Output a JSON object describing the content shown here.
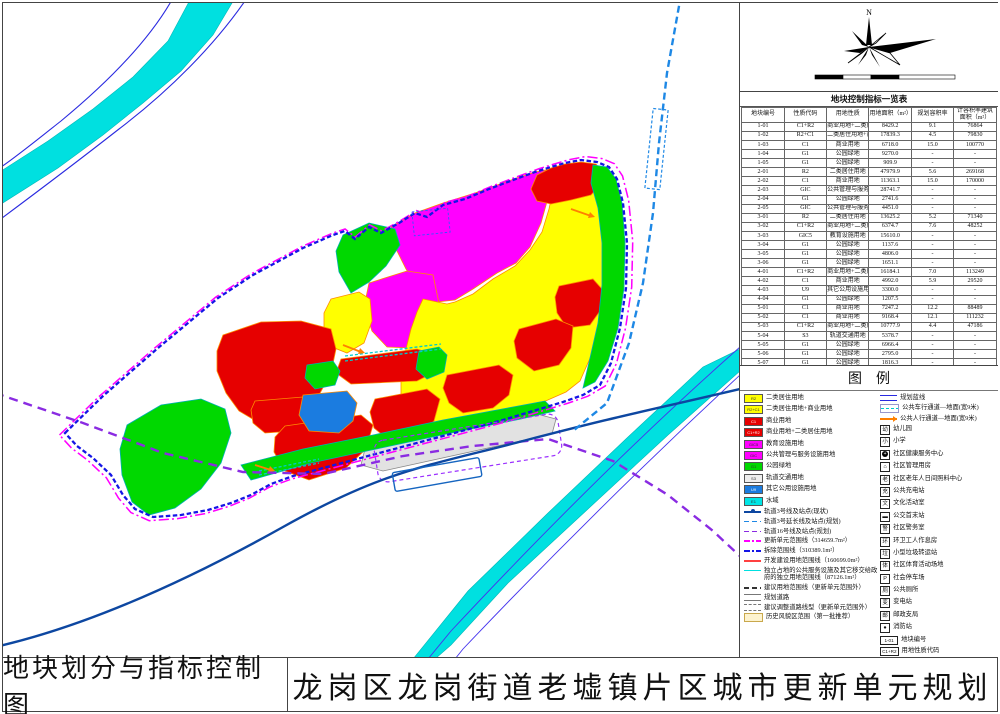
{
  "sheet": {
    "bottom_left": "地块划分与指标控制图",
    "bottom_right": "龙岗区龙岗街道老墟镇片区城市更新单元规划"
  },
  "compass": {
    "north_label": "N"
  },
  "scalebar": {
    "ticks": [
      "0",
      "40",
      "80",
      "120",
      "200m"
    ]
  },
  "table": {
    "title": "地块控制指标一览表",
    "headers": [
      "地块编号",
      "性质代码",
      "用地性质",
      "用地面积（m²）",
      "规划容积率",
      "计容积率建筑面积（m²）"
    ],
    "rows": [
      [
        "1-01",
        "C1+R2",
        "商业用地+二类居住用地",
        "8429.2",
        "9.1",
        "76864"
      ],
      [
        "1-02",
        "R2+C1",
        "二类居住用地+商业用地",
        "17839.3",
        "4.5",
        "79830"
      ],
      [
        "1-03",
        "C1",
        "商业用地",
        "6718.0",
        "15.0",
        "100770"
      ],
      [
        "1-04",
        "G1",
        "公园绿地",
        "9270.0",
        "-",
        "-"
      ],
      [
        "1-05",
        "G1",
        "公园绿地",
        "909.9",
        "-",
        "-"
      ],
      [
        "2-01",
        "R2",
        "二类居住用地",
        "47979.9",
        "5.6",
        "269168"
      ],
      [
        "2-02",
        "C1",
        "商业用地",
        "11363.1",
        "15.0",
        "170000"
      ],
      [
        "2-03",
        "GIC",
        "公共管理与服务设施用地",
        "28741.7",
        "-",
        "-"
      ],
      [
        "2-04",
        "G1",
        "公园绿地",
        "2741.6",
        "-",
        "-"
      ],
      [
        "2-05",
        "GIC",
        "公共管理与服务设施用地",
        "4451.0",
        "-",
        "-"
      ],
      [
        "3-01",
        "R2",
        "二类居住用地",
        "13625.2",
        "5.2",
        "71340"
      ],
      [
        "3-02",
        "C1+R2",
        "商业用地+二类居住用地",
        "6374.7",
        "7.6",
        "48252"
      ],
      [
        "3-03",
        "GIC5",
        "教育设施用地",
        "15610.0",
        "-",
        "-"
      ],
      [
        "3-04",
        "G1",
        "公园绿地",
        "1137.6",
        "-",
        "-"
      ],
      [
        "3-05",
        "G1",
        "公园绿地",
        "4806.0",
        "-",
        "-"
      ],
      [
        "3-06",
        "G1",
        "公园绿地",
        "1651.1",
        "-",
        "-"
      ],
      [
        "4-01",
        "C1+R2",
        "商业用地+二类居住用地",
        "16184.1",
        "7.0",
        "113249"
      ],
      [
        "4-02",
        "C1",
        "商业用地",
        "4992.0",
        "5.9",
        "29520"
      ],
      [
        "4-03",
        "U9",
        "其它公用设施用地",
        "3300.0",
        "-",
        "-"
      ],
      [
        "4-04",
        "G1",
        "公园绿地",
        "1207.5",
        "-",
        "-"
      ],
      [
        "5-01",
        "C1",
        "商业用地",
        "7247.2",
        "12.2",
        "88489"
      ],
      [
        "5-02",
        "C1",
        "商业用地",
        "9168.4",
        "12.1",
        "111232"
      ],
      [
        "5-03",
        "C1+R2",
        "商业用地+二类居住用地",
        "10777.9",
        "4.4",
        "47186"
      ],
      [
        "5-04",
        "S3",
        "轨道交通用地",
        "5378.7",
        "-",
        "-"
      ],
      [
        "5-05",
        "G1",
        "公园绿地",
        "6966.4",
        "-",
        "-"
      ],
      [
        "5-06",
        "G1",
        "公园绿地",
        "2795.0",
        "-",
        "-"
      ],
      [
        "5-07",
        "G1",
        "公园绿地",
        "1816.3",
        "-",
        "-"
      ],
      [
        "5-08",
        "S3",
        "轨道交通用地",
        "1213.2",
        "-",
        "-"
      ],
      [
        "5-09",
        "G1",
        "公园绿地",
        "331.3",
        "-",
        "-"
      ]
    ]
  },
  "legend": {
    "title": "图例",
    "left": [
      {
        "k": "fill",
        "c": "#ffff00",
        "code": "R2",
        "t": "二类居住用地"
      },
      {
        "k": "fill",
        "c": "#ffff00",
        "code": "R2+C1",
        "t": "二类居住用地+商业用地"
      },
      {
        "k": "fill",
        "c": "#e60000",
        "code": "C1",
        "t": "商业用地"
      },
      {
        "k": "fill",
        "c": "#e60000",
        "code": "C1+R2",
        "t": "商业用地+二类居住用地"
      },
      {
        "k": "fill",
        "c": "#ff00ff",
        "code": "GIC5",
        "t": "教育设施用地"
      },
      {
        "k": "fill",
        "c": "#ff00ff",
        "code": "GIC",
        "t": "公共管理与服务设施用地"
      },
      {
        "k": "fill",
        "c": "#00d800",
        "code": "G1",
        "t": "公园绿地"
      },
      {
        "k": "fill",
        "c": "#eeeeee",
        "code": "S3",
        "t": "轨道交通用地"
      },
      {
        "k": "fill",
        "c": "#1b7ce0",
        "code": "U9",
        "t": "其它公用设施用地"
      },
      {
        "k": "fill",
        "c": "#00e5e5",
        "code": "E1",
        "t": "水域"
      },
      {
        "k": "line",
        "style": "metro",
        "c": "#0d47a1",
        "t": "轨道3号线及站点(现状)"
      },
      {
        "k": "line",
        "style": "dash",
        "c": "#1e88e5",
        "t": "轨道3号延长线及站点(规划)"
      },
      {
        "k": "line",
        "style": "dash",
        "c": "#8a2be2",
        "t": "轨道16号线及站点(规划)"
      },
      {
        "k": "line",
        "style": "dashdot",
        "c": "#ff00ff",
        "t": "更新单元范围线（314659.7m²）"
      },
      {
        "k": "line",
        "style": "dashdot",
        "c": "#1515e6",
        "t": "拆除范围线（310389.1m²）"
      },
      {
        "k": "line",
        "style": "solid",
        "c": "#ff4040",
        "t": "开发建设用地范围线（160699.0m²）"
      },
      {
        "k": "line",
        "style": "solid",
        "c": "#00e0e0",
        "t": "独立占地的公共服务设施及其它移交给政府的独立用地范围线（87126.1m²）"
      },
      {
        "k": "line",
        "style": "dash",
        "c": "#333333",
        "t": "建议用地范围线（更新单元范围外）"
      },
      {
        "k": "road",
        "t": "规划道路"
      },
      {
        "k": "roaddash",
        "t": "建议调整道路线型（更新单元范围外）"
      },
      {
        "k": "hist",
        "c": "#fdf3cf",
        "t": "历史风貌区范围（第一批推荐）"
      }
    ],
    "right": [
      {
        "k": "double",
        "c": "#2a2ae0",
        "t": "规划蓝线"
      },
      {
        "k": "bracket",
        "c": "#00cccc",
        "t": "公共车行通道—地面(宽9米)"
      },
      {
        "k": "arrow",
        "c": "#ff8000",
        "t": "公共人行通道—地面(宽9米)"
      },
      {
        "k": "box",
        "ch": "幼",
        "t": "幼儿园"
      },
      {
        "k": "box",
        "ch": "小",
        "t": "小学"
      },
      {
        "k": "circlecross",
        "t": "社区健康服务中心"
      },
      {
        "k": "box",
        "ch": "⌂",
        "t": "社区管理用房"
      },
      {
        "k": "box",
        "ch": "老",
        "t": "社区老年人日间照料中心"
      },
      {
        "k": "box",
        "ch": "充",
        "t": "公共充电站"
      },
      {
        "k": "box",
        "ch": "文",
        "t": "文化活动室"
      },
      {
        "k": "box",
        "ch": "▬",
        "t": "公交首末站"
      },
      {
        "k": "box",
        "ch": "警",
        "t": "社区警务室"
      },
      {
        "k": "box",
        "ch": "环",
        "t": "环卫工人作息房"
      },
      {
        "k": "box",
        "ch": "垃",
        "t": "小型垃圾转运站"
      },
      {
        "k": "box",
        "ch": "体",
        "t": "社区体育活动场地"
      },
      {
        "k": "box",
        "ch": "P",
        "t": "社会停车场"
      },
      {
        "k": "box",
        "ch": "厕",
        "t": "公共厕所"
      },
      {
        "k": "box",
        "ch": "变",
        "t": "变电站"
      },
      {
        "k": "box",
        "ch": "邮",
        "t": "邮政支局"
      },
      {
        "k": "box",
        "ch": "●",
        "t": "消防站"
      },
      {
        "k": "code",
        "ch": "1-01",
        "t": "地块编号"
      },
      {
        "k": "code",
        "ch": "C1+R2",
        "t": "用地性质代码"
      }
    ]
  },
  "map": {
    "station_label": "双龙站",
    "road_chars": [
      [
        "龙",
        262,
        49
      ],
      [
        "岗",
        212,
        67
      ],
      [
        "河",
        167,
        88
      ],
      [
        "园",
        182,
        110
      ],
      [
        "陈",
        264,
        90
      ],
      [
        "屋",
        285,
        110
      ],
      [
        "路",
        292,
        130
      ],
      [
        "罗",
        310,
        152
      ],
      [
        "福",
        337,
        173
      ],
      [
        "路",
        362,
        194
      ],
      [
        "罗",
        285,
        152
      ],
      [
        "路",
        325,
        120
      ],
      [
        "福",
        50,
        108
      ],
      [
        "园",
        44,
        143
      ],
      [
        "路",
        38,
        178
      ],
      [
        "宁",
        146,
        178
      ],
      [
        "路",
        103,
        175
      ],
      [
        "上",
        167,
        233
      ],
      [
        "路",
        220,
        205
      ],
      [
        "兴",
        449,
        63
      ],
      [
        "运",
        468,
        92
      ],
      [
        "路",
        488,
        118
      ],
      [
        "升",
        532,
        67
      ],
      [
        "中",
        567,
        33
      ],
      [
        "东",
        430,
        181
      ],
      [
        "街",
        557,
        218
      ],
      [
        "西",
        424,
        290
      ],
      [
        "岗",
        458,
        373
      ],
      [
        "街",
        456,
        398
      ],
      [
        "宁",
        337,
        368
      ],
      [
        "路",
        358,
        417
      ],
      [
        "龙",
        299,
        389
      ],
      [
        "福",
        315,
        320
      ],
      [
        "老",
        533,
        317
      ],
      [
        "街",
        588,
        337
      ],
      [
        "大",
        637,
        248
      ],
      [
        "道",
        625,
        328
      ],
      [
        "龙",
        205,
        583
      ],
      [
        "岗",
        288,
        532
      ],
      [
        "大",
        377,
        484
      ],
      [
        "道",
        505,
        430
      ],
      [
        "南",
        502,
        502
      ],
      [
        "约",
        455,
        540
      ],
      [
        "河",
        400,
        592
      ],
      [
        "深",
        674,
        478
      ],
      [
        "汕",
        688,
        502
      ],
      [
        "公",
        700,
        527
      ],
      [
        "路",
        716,
        549
      ],
      [
        "龙",
        667,
        60
      ],
      [
        "回",
        666,
        148
      ],
      [
        "龙",
        670,
        167
      ],
      [
        "埔",
        674,
        186
      ],
      [
        "平",
        68,
        452
      ],
      [
        "瑞",
        147,
        467
      ],
      [
        "祥",
        115,
        493
      ],
      [
        "路",
        85,
        522
      ],
      [
        "龙",
        110,
        405
      ],
      [
        "龙",
        167,
        412
      ],
      [
        "兴",
        197,
        455
      ],
      [
        "街",
        242,
        500
      ],
      [
        "龙",
        95,
        573
      ]
    ],
    "parcels": [
      [
        "1-01",
        "C1+R2",
        566,
        168,
        0,
        0
      ],
      [
        "1-02",
        "R2+C1",
        566,
        215,
        0,
        0
      ],
      [
        "1-03",
        "C1",
        575,
        292,
        0,
        0
      ],
      [
        "1-04",
        "G1",
        609,
        252,
        -72,
        1
      ],
      [
        "1-05",
        "G1",
        621,
        227,
        -72,
        1
      ],
      [
        "2-01",
        "R2",
        492,
        286,
        0,
        0
      ],
      [
        "2-02",
        "C1",
        540,
        334,
        0,
        0
      ],
      [
        "2-03",
        "GIC",
        463,
        213,
        0,
        0
      ],
      [
        "2-04",
        "G1",
        627,
        352,
        -72,
        1
      ],
      [
        "2-05",
        "GIC",
        424,
        202,
        0,
        0
      ],
      [
        "3-01",
        "R2",
        349,
        306,
        0,
        0
      ],
      [
        "3-02",
        "C1+R2",
        378,
        362,
        0,
        0
      ],
      [
        "3-03",
        "GIC5",
        396,
        290,
        0,
        0
      ],
      [
        "3-04",
        "G1",
        428,
        359,
        0,
        1
      ],
      [
        "3-05",
        "G1",
        373,
        238,
        -55,
        1
      ],
      [
        "3-06",
        "G1",
        362,
        264,
        -55,
        1
      ],
      [
        "4-01",
        "C1+R2",
        278,
        339,
        0,
        0
      ],
      [
        "4-02",
        "C1",
        283,
        410,
        0,
        0
      ],
      [
        "4-03",
        "U9",
        327,
        401,
        0,
        0
      ],
      [
        "4-04",
        "G1",
        320,
        372,
        0,
        1
      ],
      [
        "5-01",
        "C1",
        476,
        385,
        0,
        0
      ],
      [
        "5-02",
        "C1",
        411,
        402,
        0,
        0
      ],
      [
        "5-03",
        "C1+R2",
        337,
        430,
        0,
        0
      ],
      [
        "5-04",
        "S3",
        413,
        432,
        -10,
        1
      ],
      [
        "5-05",
        "G1",
        176,
        441,
        0,
        1
      ],
      [
        "5-06",
        "G1",
        494,
        409,
        -10,
        1
      ],
      [
        "5-07",
        "G1",
        330,
        474,
        -8,
        1
      ],
      [
        "5-08",
        "S3",
        558,
        420,
        -10,
        1
      ],
      [
        "5-09",
        "G1",
        254,
        483,
        0,
        1
      ]
    ],
    "facility_icons": [
      {
        "x": 562,
        "y": 238,
        "items": [
          [
            "⌂",
            1
          ],
          [
            "▬",
            1
          ]
        ]
      },
      {
        "x": 562,
        "y": 250,
        "items": [
          [
            "老",
            0
          ],
          [
            "⊕",
            1
          ]
        ]
      },
      {
        "x": 570,
        "y": 309,
        "items": [
          [
            "充",
            0
          ]
        ]
      },
      {
        "x": 484,
        "y": 305,
        "items": [
          [
            "幼",
            0
          ],
          [
            "▬",
            1
          ]
        ]
      },
      {
        "x": 528,
        "y": 352,
        "items": [
          [
            "P",
            0
          ]
        ]
      },
      {
        "x": 346,
        "y": 327,
        "items": [
          [
            "幼",
            0
          ]
        ]
      },
      {
        "x": 380,
        "y": 372,
        "items": [
          [
            "P",
            0
          ],
          [
            "厕",
            0
          ]
        ]
      },
      {
        "x": 260,
        "y": 357,
        "items": [
          [
            "幼",
            0
          ],
          [
            "♠",
            1
          ]
        ]
      },
      {
        "x": 260,
        "y": 370,
        "items": [
          [
            "▬",
            1
          ],
          [
            "充",
            0
          ]
        ]
      },
      {
        "x": 315,
        "y": 416,
        "items": [
          [
            "垃",
            0
          ]
        ]
      },
      {
        "x": 392,
        "y": 417,
        "items": [
          [
            "♠",
            1
          ],
          [
            "♠",
            1
          ]
        ]
      },
      {
        "x": 292,
        "y": 447,
        "items": [
          [
            "⌂",
            1
          ],
          [
            "▬",
            1
          ],
          [
            "♠",
            1
          ]
        ]
      },
      {
        "x": 292,
        "y": 460,
        "items": [
          [
            "▬",
            1
          ],
          [
            "P",
            0
          ]
        ]
      }
    ],
    "annotations": [
      {
        "t": "轨道3号延长线(规划)",
        "x": 543,
        "y": 97,
        "s": 7,
        "lx": [
          [
            612,
            95
          ],
          [
            660,
            92
          ]
        ],
        "dot": [
          660,
          92
        ]
      },
      {
        "t": "轨道龙岗线（3号线）",
        "x": 276,
        "y": 589,
        "s": 7,
        "lx": [
          [
            274,
            585
          ],
          [
            249,
            562
          ]
        ],
        "dot": [
          248,
          560
        ]
      },
      {
        "t": "轨道线（16号线）",
        "x": 645,
        "y": 550,
        "s": 7,
        "lx": [
          [
            700,
            547
          ],
          [
            712,
            528
          ]
        ],
        "dot": [
          712,
          527
        ]
      },
      {
        "t": "双龙站",
        "x": 410,
        "y": 486,
        "s": 9
      },
      {
        "t": "龙塘世居",
        "x": 404,
        "y": 222,
        "s": 4.8,
        "c": "#cc0000"
      }
    ]
  }
}
